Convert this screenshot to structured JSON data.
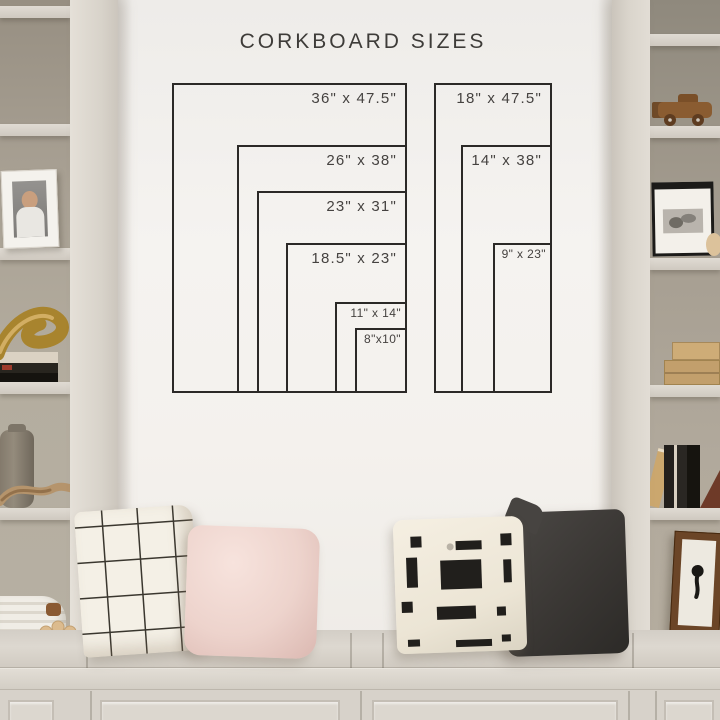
{
  "title": "CORKBOARD SIZES",
  "diagram": {
    "units": "inches",
    "groups": [
      {
        "name": "standard-widths",
        "boards": [
          {
            "label": "36\" x 47.5\"",
            "w_in": 36,
            "h_in": 47.5
          },
          {
            "label": "26\" x 38\"",
            "w_in": 26,
            "h_in": 38
          },
          {
            "label": "23\" x 31\"",
            "w_in": 23,
            "h_in": 31
          },
          {
            "label": "18.5\" x 23\"",
            "w_in": 18.5,
            "h_in": 23
          },
          {
            "label": "11\" x 14\"",
            "w_in": 11,
            "h_in": 14
          },
          {
            "label": "8\"x10\"",
            "w_in": 8,
            "h_in": 10
          }
        ]
      },
      {
        "name": "narrow-widths",
        "boards": [
          {
            "label": "18\" x 47.5\"",
            "w_in": 18,
            "h_in": 47.5
          },
          {
            "label": "14\" x 38\"",
            "w_in": 14,
            "h_in": 38
          },
          {
            "label": "9\" x 23\"",
            "w_in": 9,
            "h_in": 23
          }
        ]
      }
    ]
  },
  "palette": {
    "wall": "#f4f1ed",
    "outline": "#2b2927",
    "label_text": "#454240",
    "cabinet": "#d8d3cb",
    "shelf_interior": "#aaa295",
    "pillow_windowpane": "#f4f0e6",
    "pillow_blush": "#eed6d0",
    "pillow_block_print": "#f0e9dc",
    "pillow_block_ink": "#211f1c",
    "pillow_charcoal": "#3a3734",
    "wood": "#8a5c31",
    "brass": "#b08b3e"
  },
  "scene": {
    "left_shelf_items": [
      "framed-child-photo",
      "brass-sculpture",
      "book-stack",
      "ceramic-urn",
      "driftwood",
      "rope-basket",
      "wood-beads"
    ],
    "right_shelf_items": [
      "wooden-toy-car",
      "framed-baby-photo",
      "wooden-crates",
      "leaning-books",
      "bookend",
      "framed-ink-art"
    ],
    "bench_items": [
      "windowpane-pillow",
      "blush-pillow",
      "block-print-pillow",
      "charcoal-pillow"
    ]
  }
}
